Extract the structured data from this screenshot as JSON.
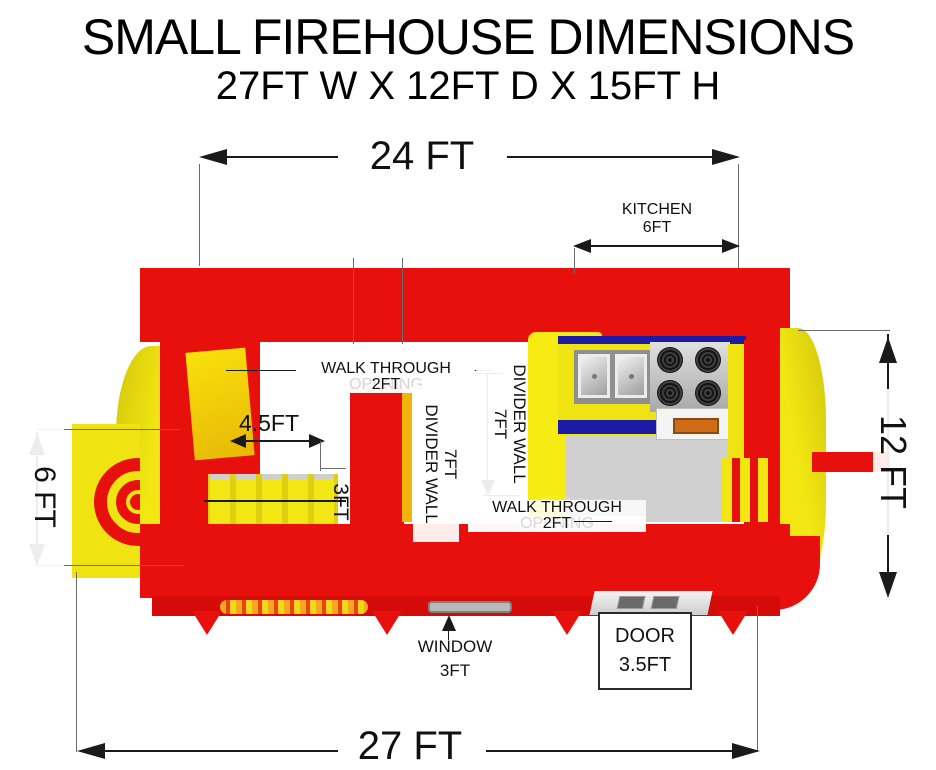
{
  "title": "SMALL FIREHOUSE DIMENSIONS",
  "subtitle": "27FT W X 12FT D X 15FT H",
  "colors": {
    "red": "#e8100c",
    "yellow": "#efe411",
    "blue": "#1b1ba6",
    "ink": "#1a1a1a"
  },
  "annotations": {
    "top_width": "24 FT",
    "bottom_width": "27 FT",
    "depth_right": "12 FT",
    "entrance_left": "6 FT",
    "kitchen": {
      "name": "KITCHEN",
      "size": "6FT"
    },
    "walkthrough_top": {
      "name": "WALK THROUGH OPENING",
      "size": "2FT"
    },
    "walkthrough_bottom": {
      "name": "WALK THROUGH OPENING",
      "size": "2FT"
    },
    "obstacle_span": "4.5FT",
    "obstacle_depth": "3FT",
    "divider1": {
      "name": "DIVIDER WALL",
      "size": "7FT"
    },
    "divider2": {
      "name": "DIVIDER WALL",
      "size": "7FT"
    },
    "window": {
      "name": "WINDOW",
      "size": "3FT"
    },
    "door": {
      "name": "DOOR",
      "size": "3.5FT"
    }
  }
}
